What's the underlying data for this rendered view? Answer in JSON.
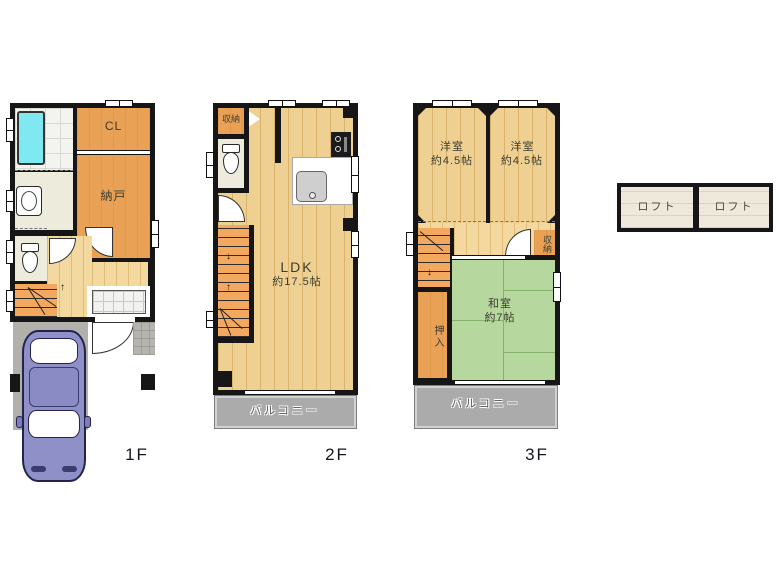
{
  "title": "間取り図 (floor plan)",
  "colors": {
    "wall": "#161616",
    "room_orange": "#e9a156",
    "wood_floor": "#eed092",
    "hall_wood": "#f3d9a0",
    "stairs_orange": "#f2a85e",
    "tatami_green": "#b6d89e",
    "balcony_gray": "#ababab",
    "driveway_gray": "#b2b0ab",
    "bathtub_cyan": "#7fe9f1",
    "washroom_cream": "#edebdc",
    "loft_beige": "#efe9db",
    "car_blue": "#9090c8",
    "background": "#ffffff"
  },
  "icons": {
    "up_arrow": "↑",
    "down_arrow": "↓"
  },
  "floors": {
    "f1": {
      "label": "1F",
      "cl": "CL",
      "nando": "納戸"
    },
    "f2": {
      "label": "2F",
      "shuno": "収納",
      "ldk": "LDK",
      "ldk_size": "約17.5帖",
      "balcony": "バルコニー"
    },
    "f3": {
      "label": "3F",
      "yoshitsu1": "洋室",
      "yoshitsu1_size": "約4.5帖",
      "yoshitsu2": "洋室",
      "yoshitsu2_size": "約4.5帖",
      "washitsu": "和室",
      "washitsu_size": "約7帖",
      "oshiire": "押入",
      "shuno": "収納",
      "balcony": "バルコニー"
    },
    "loft": {
      "left": "ロフト",
      "right": "ロフト"
    }
  }
}
